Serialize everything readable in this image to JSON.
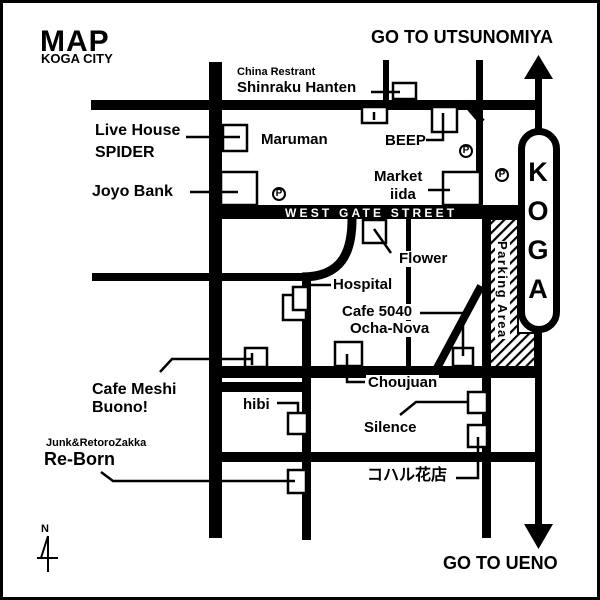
{
  "header": {
    "title": "MAP",
    "subtitle": "KOGA CITY"
  },
  "directions": {
    "north_destination": "GO TO UTSUNOMIYA",
    "south_destination": "GO TO UENO"
  },
  "station": {
    "name": "KOGA"
  },
  "streets": {
    "west_gate": "WEST GATE STREET"
  },
  "parking": {
    "area_label": "Parking Area",
    "p_symbol": "P"
  },
  "compass": {
    "north_label": "N"
  },
  "places": {
    "china_restrant_note": "China Restrant",
    "shinraku_hanten": "Shinraku Hanten",
    "live_house_line1": "Live House",
    "live_house_line2": "SPIDER",
    "maruman": "Maruman",
    "beep": "BEEP",
    "joyo_bank": "Joyo Bank",
    "market_line1": "Market",
    "market_line2": "iida",
    "flower": "Flower",
    "hospital": "Hospital",
    "cafe5040_line1": "Cafe 5040",
    "cafe5040_line2": "Ocha-Nova",
    "cafe_meshi_line1": "Cafe Meshi",
    "cafe_meshi_line2": "Buono!",
    "choujuan": "Choujuan",
    "hibi": "hibi",
    "silence": "Silence",
    "junk_note": "Junk&RetoroZakka",
    "reborn": "Re-Born",
    "koharu": "コハル花店"
  },
  "colors": {
    "ink": "#000000",
    "paper": "#ffffff"
  }
}
